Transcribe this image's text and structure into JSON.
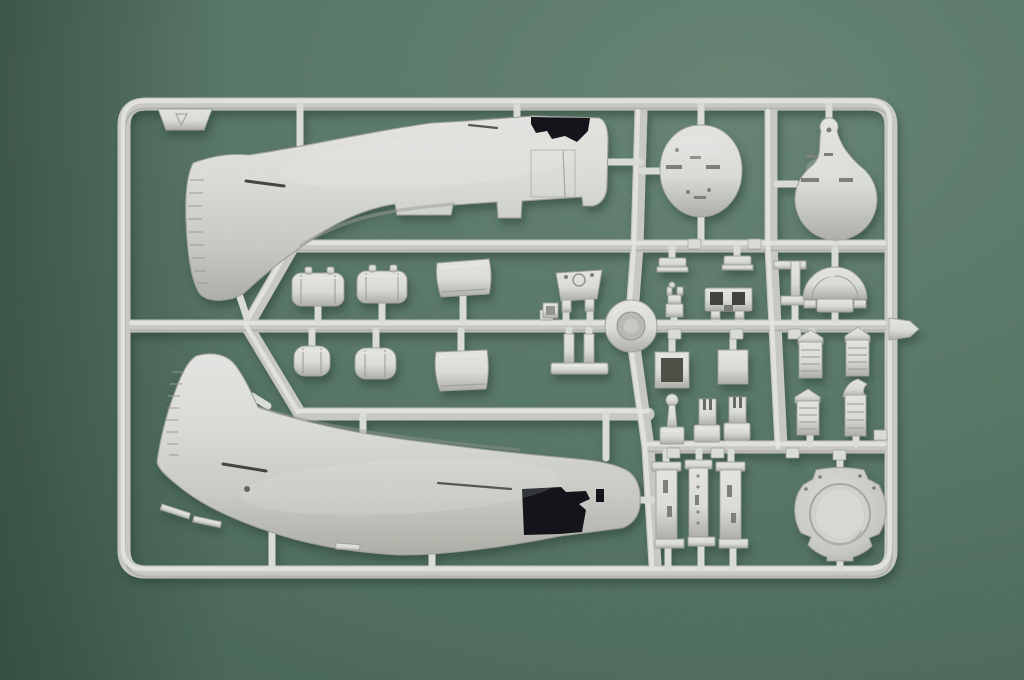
{
  "scene": {
    "type": "photograph",
    "subject": "Injection-molded plastic model kit sprue (runner frame) of aircraft parts",
    "material": "light grey styrene plastic",
    "surface": "green felt mat",
    "lighting": "soft light from upper left, cast shadow below-right of sprue"
  },
  "palette": {
    "mat_light": "#749d86",
    "mat_mid": "#5f8973",
    "mat_dark": "#48705d",
    "mat_corner_shadow": "#31503f",
    "plastic_highlight": "#f1f2ee",
    "plastic_light": "#e6e8e2",
    "plastic_mid": "#d2d4cd",
    "plastic_shadow": "#b7b9b1",
    "plastic_deep": "#9b9d95",
    "part_edge": "#a8aaa2",
    "cutout_dark": "#17191c",
    "cast_shadow": "#2a4335"
  },
  "sprue": {
    "frame": "rounded rectangular outer runner with internal horizontal, vertical and diagonal runners",
    "features": [
      "molded ring boss at central runner junction",
      "illegible part-number bosses along runners",
      "sprue letter tab at top-left corner",
      "injection gate tab protruding from right rail"
    ],
    "parts": [
      {
        "id": "fuselage-half-upper",
        "label": "aircraft fuselage half, nose right, tail fin lower-left, open cockpit notch on deck",
        "count": 1
      },
      {
        "id": "fuselage-half-lower",
        "label": "aircraft fuselage half, nose right, tail fin upper-left, rectangular cockpit cutout",
        "count": 1
      },
      {
        "id": "oval-bulkhead",
        "label": "egg-shaped bulkhead disc with slot details",
        "count": 1
      },
      {
        "id": "teardrop-bulkhead",
        "label": "teardrop-shaped bulkhead with round nub",
        "count": 1
      },
      {
        "id": "cylindrical-tank-large",
        "label": "horizontal ribbed cylindrical tank with filler nubs",
        "count": 2
      },
      {
        "id": "cylindrical-tank-small",
        "label": "small cylindrical canister",
        "count": 2
      },
      {
        "id": "curved-cowl-panel",
        "label": "curved rectangular cowl panel",
        "count": 2
      },
      {
        "id": "instrument-pedestal",
        "label": "trapezoid instrument pedestal with two legs",
        "count": 1
      },
      {
        "id": "mount-frame",
        "label": "H-shaped engine/seat mount frame with foot plate",
        "count": 1
      },
      {
        "id": "pedal-plate",
        "label": "small stepped pedal plate",
        "count": 2
      },
      {
        "id": "gunsight",
        "label": "small stacked gunsight with prongs",
        "count": 1
      },
      {
        "id": "slotted-bracket",
        "label": "bracket with two square openings",
        "count": 1
      },
      {
        "id": "strut-bracket",
        "label": "L-shaped strut bracket",
        "count": 1
      },
      {
        "id": "headrest-armor",
        "label": "semicircular headrest plate on base",
        "count": 1
      },
      {
        "id": "exhaust-stack",
        "label": "ribbed exhaust / intake stack",
        "count": 4
      },
      {
        "id": "control-stick",
        "label": "control stick with ball grip on base block",
        "count": 1
      },
      {
        "id": "forked-lever",
        "label": "small forked lever on base block",
        "count": 2
      },
      {
        "id": "floor-strip",
        "label": "flat slotted strip with end caps",
        "count": 3
      },
      {
        "id": "engine-firewall",
        "label": "round engine firewall with recessed circular ring and notched rim",
        "count": 1
      },
      {
        "id": "open-box",
        "label": "small open square box",
        "count": 1
      },
      {
        "id": "solid-box",
        "label": "small solid box",
        "count": 1
      },
      {
        "id": "ring-boss",
        "label": "molded ring at runner crossing",
        "count": 1
      }
    ]
  }
}
